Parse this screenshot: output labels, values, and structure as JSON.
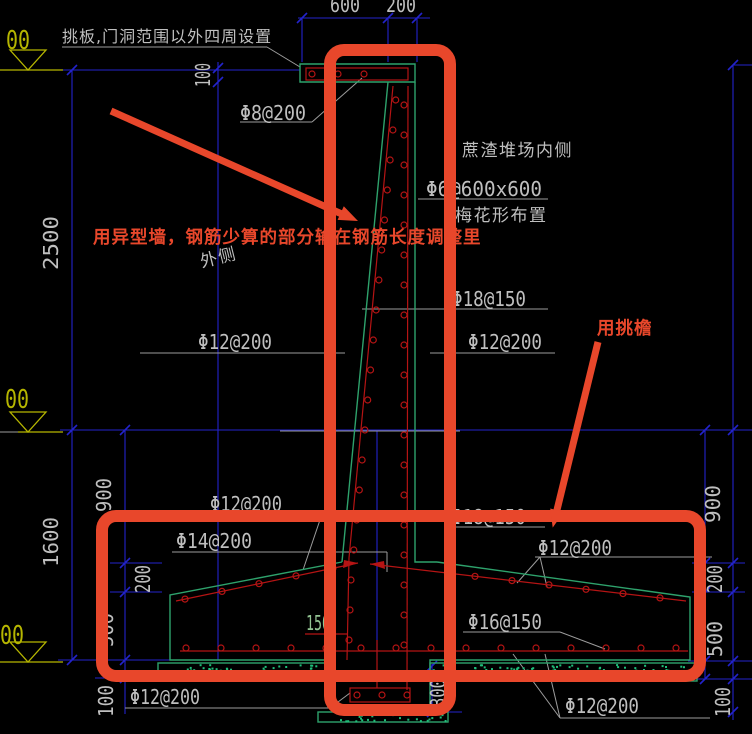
{
  "notes": {
    "top": "挑板,门洞范围以外四周设置",
    "yard": "蔗渣堆场内侧",
    "mesh": "Φ6@600x600",
    "mesh_layout": "梅花形布置",
    "outer": "外侧"
  },
  "rebar": {
    "slab": "Φ8@200",
    "wall_main": "Φ18@150",
    "wall_left": "Φ12@200",
    "wall_right": "Φ12@200",
    "foot_top_left": "Φ12@200",
    "foot_slope_left": "Φ14@200",
    "foot_top_right": "Φ18@150",
    "foot_slope_right": "Φ12@200",
    "foot_bottom_right": "Φ16@150",
    "bottom_left": "Φ12@200",
    "bottom_right": "Φ12@200"
  },
  "dims": {
    "top_a": "600",
    "top_b": "200",
    "slab_t": "100",
    "wall_h": "2500",
    "foot_h": "1600",
    "l900": "900",
    "l200": "200",
    "l500": "500",
    "l100": "100",
    "r900": "900",
    "r200": "200",
    "r500": "500",
    "r100": "100",
    "key_w": "150",
    "key_d": "300"
  },
  "elev": {
    "top": "00",
    "mid": "00",
    "bot": "00"
  },
  "markup": {
    "note1": "用异型墙，钢筋少算的部分输在钢筋长度调整里",
    "note2": "用挑檐"
  },
  "colors": {
    "dim_blue": "#2323cc",
    "leader_gray": "#9d9d9d",
    "outline_green": "#2ea26c",
    "speckle_green": "#1fbf7a",
    "rebar_red": "#b51414",
    "elev_yellow": "#b6b600",
    "cad_text": "#bfbfbf",
    "dim_green_text": "#93c493",
    "markup_red": "#e8472b"
  }
}
